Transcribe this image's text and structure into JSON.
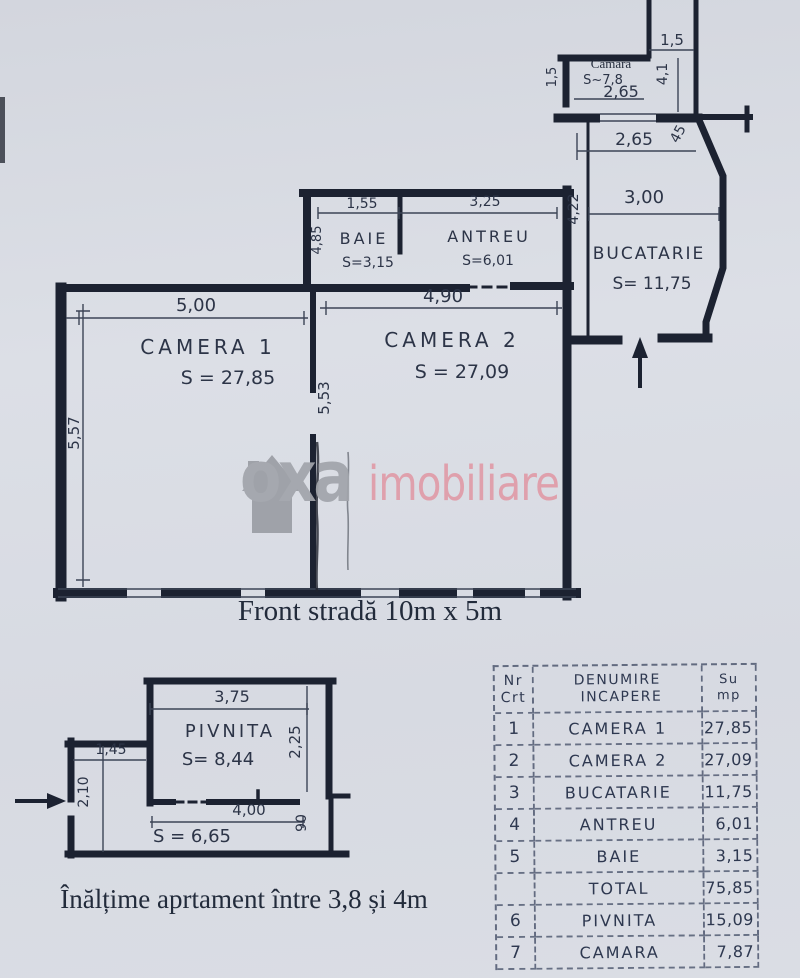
{
  "plan": {
    "shaft": {
      "dim": "1,5"
    },
    "camara": {
      "title": "Cămara",
      "area": "S~7,8",
      "width": "2,65",
      "left_dim": "1,5",
      "right_dim": "4,1"
    },
    "bucatarie": {
      "name": "BUCATARIE",
      "area": "S= 11,75",
      "top_width": "2,65",
      "notch": "45",
      "width": "3,00",
      "height": "4,22"
    },
    "baie": {
      "name": "BAIE",
      "area": "S=3,15",
      "width": "1,55",
      "height": "4,85"
    },
    "antreu": {
      "name": "ANTREU",
      "area": "S=6,01",
      "width": "3,25"
    },
    "camera1": {
      "name": "CAMERA 1",
      "area": "S = 27,85",
      "width": "5,00",
      "height": "5,57"
    },
    "camera2": {
      "name": "CAMERA 2",
      "area": "S = 27,09",
      "width": "4,90",
      "height": "5,53"
    }
  },
  "pivnita": {
    "name": "PIVNITA",
    "area": "S= 8,44",
    "lower_area": "S = 6,65",
    "top_width": "3,75",
    "right_height": "2,25",
    "corridor_width": "1,45",
    "left_height": "2,10",
    "bottom_width": "4,00",
    "opening": "90"
  },
  "captions": {
    "front_street": "Front stradă 10m x 5m",
    "height_note": "Înălțime aprtament între 3,8 și 4m"
  },
  "watermark": {
    "brand_gray": "oxa",
    "brand_pink": "imobiliare",
    "gray_color": "#a2a5ab",
    "pink_color": "#e09ca8"
  },
  "table": {
    "header": {
      "col1_line1": "Nr",
      "col1_line2": "Crt",
      "col2_line1": "DENUMIRE",
      "col2_line2": "INCAPERE",
      "col3_line1": "Su",
      "col3_line2": "mp"
    },
    "rows": [
      {
        "nr": "1",
        "name": "CAMERA 1",
        "value": "27,85"
      },
      {
        "nr": "2",
        "name": "CAMERA 2",
        "value": "27,09"
      },
      {
        "nr": "3",
        "name": "BUCATARIE",
        "value": "11,75"
      },
      {
        "nr": "4",
        "name": "ANTREU",
        "value": "6,01"
      },
      {
        "nr": "5",
        "name": "BAIE",
        "value": "3,15"
      },
      {
        "nr": "",
        "name": "TOTAL",
        "value": "75,85"
      },
      {
        "nr": "6",
        "name": "PIVNITA",
        "value": "15,09"
      },
      {
        "nr": "7",
        "name": "CAMARA",
        "value": "7,87"
      }
    ]
  }
}
